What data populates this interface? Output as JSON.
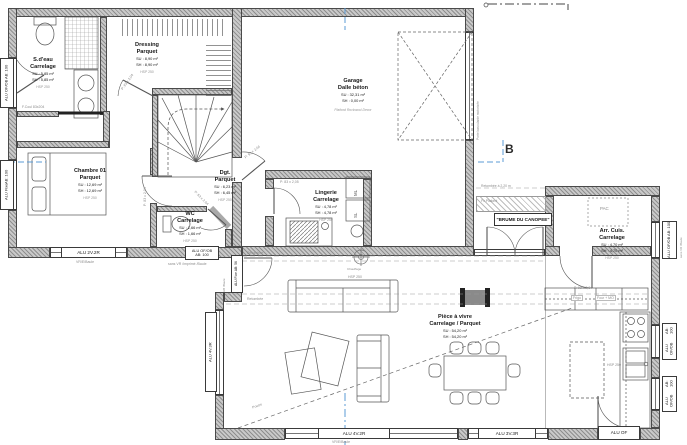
{
  "section_marker": "B",
  "project_name": "\"BRUME DU CANOPEE\"",
  "rooms": {
    "sdeau": {
      "name": "S.d'eau",
      "material": "Carrelage",
      "su": "SU : 5,85 m²",
      "sh": "SH : 5,85 m²",
      "hsp": "HSP 250"
    },
    "dressing": {
      "name": "Dressing",
      "material": "Parquet",
      "su": "SU : 8,90 m²",
      "sh": "SH : 8,90 m²",
      "hsp": "HSP 250"
    },
    "chambre": {
      "name": "Chambre 01",
      "material": "Parquet",
      "su": "SU : 12,69 m²",
      "sh": "SH : 12,69 m²",
      "hsp": "HSP 250"
    },
    "dgt": {
      "name": "Dgt.",
      "material": "Parquet",
      "su": "SU : 6,23 m²",
      "sh": "SH : 6,45 m²",
      "hsp": "HSP 250"
    },
    "wc": {
      "name": "WC",
      "material": "Carrelage",
      "su": "SU : 1,66 m²",
      "sh": "SH : 1,66 m²",
      "hsp": "HSP 250"
    },
    "lingerie": {
      "name": "Lingerie",
      "material": "Carrelage",
      "su": "SU : 4,78 m²",
      "sh": "SH : 4,78 m²",
      "hsp": "HSP 250"
    },
    "garage": {
      "name": "Garage",
      "material": "Dalle béton",
      "su": "SU : 32,31 m²",
      "sh": "SH : 0,00 m²",
      "note": "Plafond Rockwool Decor"
    },
    "piece": {
      "name": "Pièce à vivre",
      "material": "Carrelage / Parquet",
      "su": "SU : 54,20 m²",
      "sh": "SH : 54,20 m²",
      "hsp": "HSP 250"
    },
    "arrcuis": {
      "name": "Arr. Cuis.",
      "material": "Carrelage",
      "su": "SU : 4,70 m²",
      "sh": "SH : 4,70 m²",
      "hsp": "HSP 250"
    }
  },
  "windows": {
    "left_top": {
      "l1": "ALU OF/OB",
      "l2": "AB: 100"
    },
    "left_mid": {
      "l1": "ALU Fixe",
      "l2": "AB: 100"
    },
    "bed_main": {
      "label": "ALU 2V.2R",
      "sub": "VR/E/Baule"
    },
    "bed_small": {
      "l1": "ALU OF/OB",
      "l2": "AB: 100",
      "sub": "sans VR /imprimé /Baule"
    },
    "entry": {
      "label": "ALU Fixe AB: 56",
      "sub": "HB /Baule"
    },
    "living_left": {
      "label": "ALU 4V.3R"
    },
    "living_main": {
      "label": "ALU 4V.2R",
      "sub": "VR/E/Baule"
    },
    "living_small": {
      "label": "ALU 3V.3R"
    },
    "kitchen_door": {
      "label": "ALU OF"
    },
    "kitchen_right_1": {
      "l1": "ALU OF/OB",
      "l2": "AB: 100"
    },
    "kitchen_right_2": {
      "l1": "ALU OF/OB",
      "l2": "AB: 100"
    },
    "arrcuis_right": {
      "l1": "ALU OF/OB",
      "l2": "AB: 100",
      "sub": "sans VR /Baule"
    }
  },
  "doors": {
    "sliding_bath": "F.Coul 83x204",
    "dressing": "P: 83 x 2,04",
    "chambre": "P: 83 x 2,04",
    "wc": "P: 63 x 2,04",
    "garage_service": "P: 93 x 2,04",
    "lingerie": "P: 83 x 2,05",
    "arrcuis": "P. 93 x 2,04",
    "garage_main": "Porte basculante motorisée"
  },
  "appliances": {
    "ml": "ML",
    "sl": "SL",
    "pac": "PAC",
    "frigo": "Frigo",
    "four": "Four + MO"
  },
  "annotations": {
    "retombee_long": "Retombée à 2,20 m",
    "fx_plafond": "Fx Plafond",
    "retombee_hall": "Retombée",
    "retombee_living": "Retombée",
    "poutre": "Poutre",
    "chauffage": "Chauffage",
    "hsp_hall": "HSP 250",
    "hsp_kitchen": "HSP 250"
  }
}
